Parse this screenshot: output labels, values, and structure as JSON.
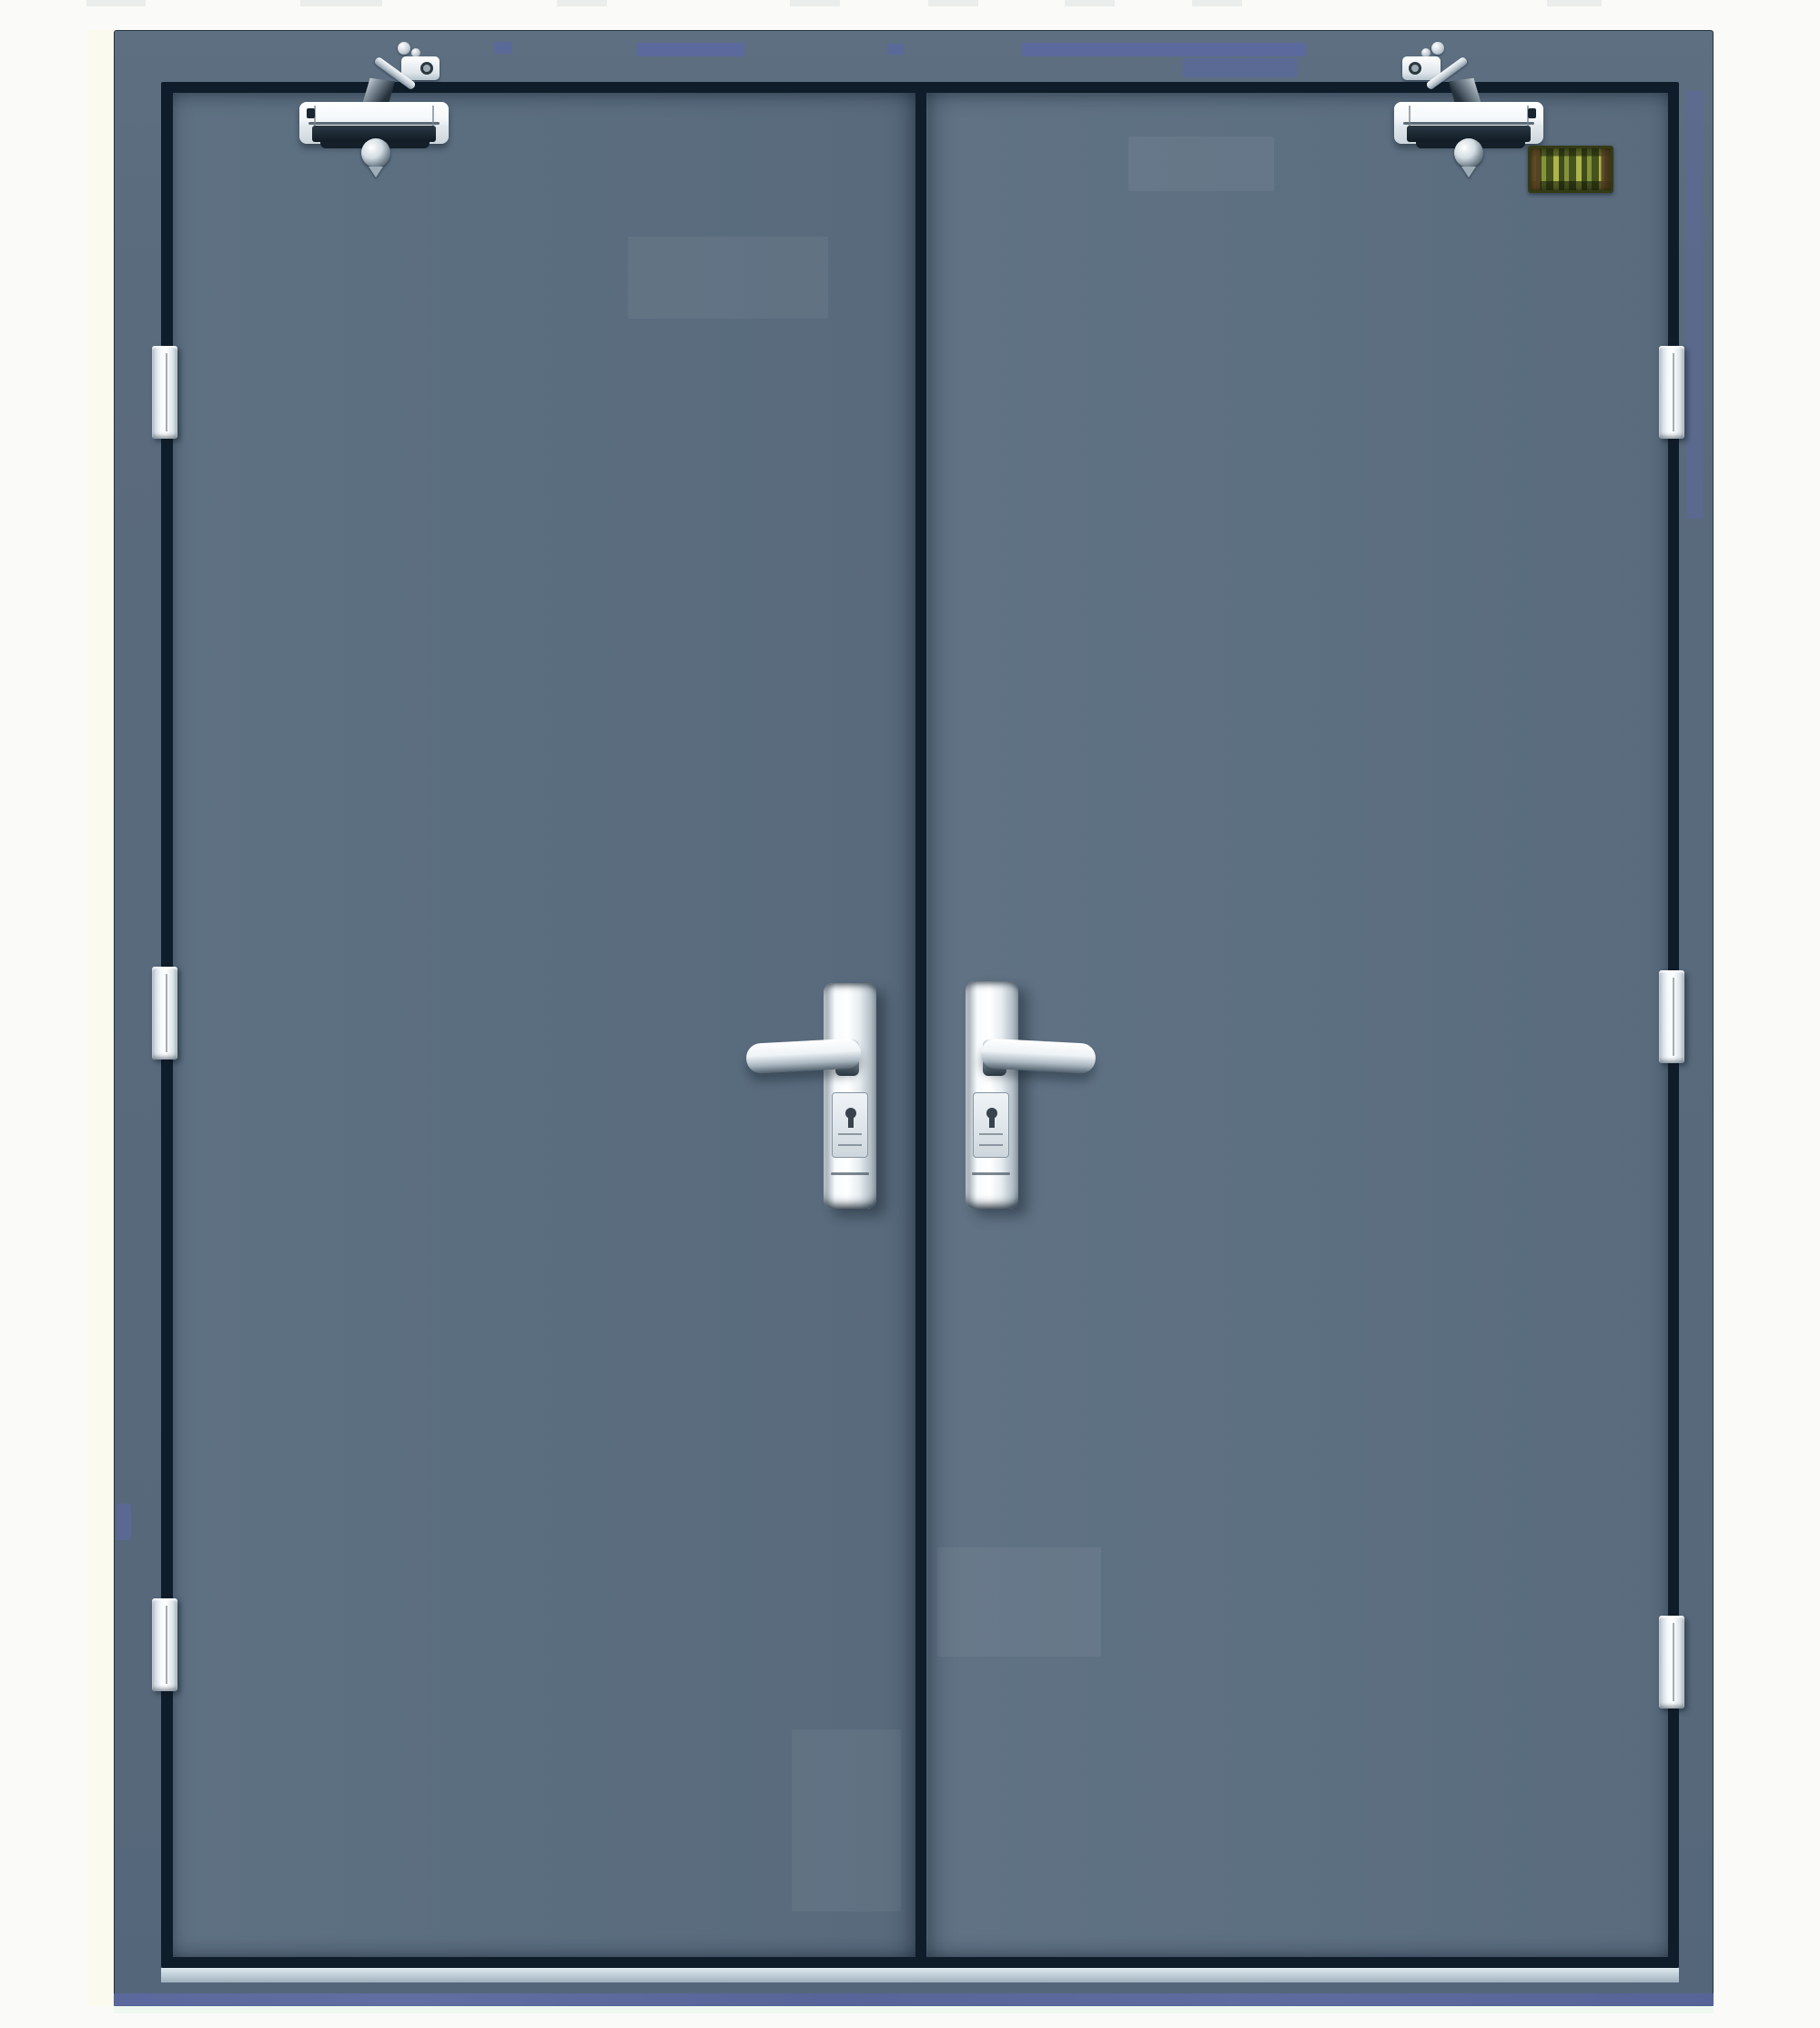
{
  "meta": {
    "image_type": "product-photo",
    "subject": "Double-leaf steel fire door, front view, gray-blue finish",
    "visible_text": "none (small certification sticker text is illegible)"
  },
  "palette": {
    "background": "#fafbf9",
    "paper_edge": "#e7e9e9",
    "frame_face": "#5a6b7d",
    "frame_border": "#26323e",
    "door_face_left": "#5b6e80",
    "door_face_right": "#5d7082",
    "gap_dark": "#0f1d2b",
    "accent_lavender": "#5b689e",
    "accent_cream": "#fafae8",
    "hardware_white": "#f5f9fb",
    "hardware_mid": "#c9d4db",
    "hardware_dark": "#1a2630",
    "sill_silver": "#c3d1da",
    "bottom_mint": "#eef8f0",
    "label_olive": "#5f6c2d",
    "label_border": "#333b16",
    "label_glyph": "#b9c24f"
  },
  "components": {
    "door_leaves": 2,
    "door_closers": [
      {
        "side": "left",
        "mounted": "top of left leaf, arm attached to frame head"
      },
      {
        "side": "right",
        "mounted": "top of right leaf, arm attached to frame head"
      }
    ],
    "hinges": {
      "per_side": 3,
      "sides": [
        "left",
        "right"
      ],
      "finish": "polished chrome"
    },
    "handles": [
      {
        "side": "left",
        "type": "lever on escutcheon plate with keyhole",
        "lever_points": "left"
      },
      {
        "side": "right",
        "type": "lever on escutcheon plate with keyhole",
        "lever_points": "right"
      }
    ],
    "certification_label": {
      "position": "upper area of right leaf, below door closer",
      "color": "olive green with dark border",
      "legible": false
    },
    "threshold_sill": {
      "finish": "silver aluminium strip"
    }
  }
}
